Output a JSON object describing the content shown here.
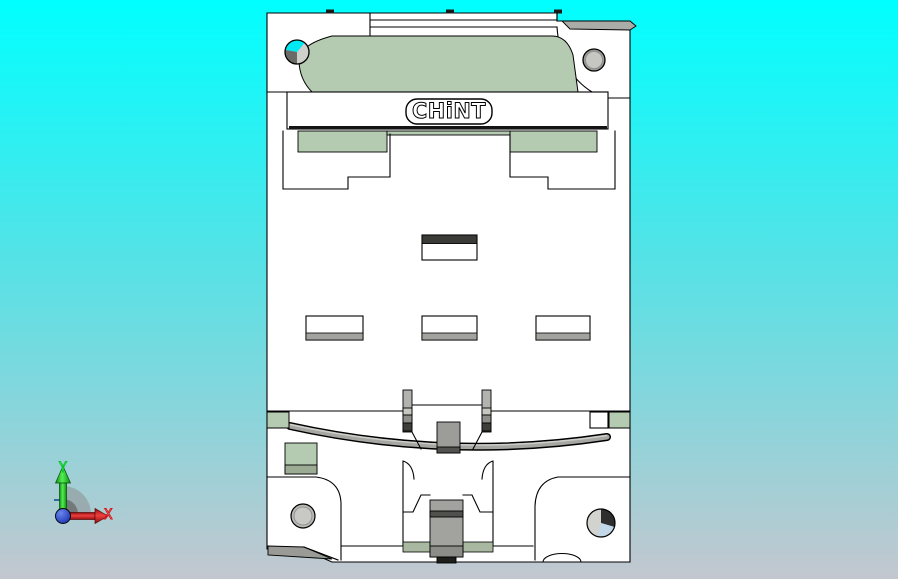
{
  "viewport": {
    "width": 898,
    "height": 579,
    "background_top": "#00ffff",
    "background_mid": "#55e2e6",
    "background_bottom": "#c3c7cf"
  },
  "model": {
    "brand_label": "CHiNT",
    "body_color": "#ffffff",
    "panel_green": "#b4cab1",
    "band_green": "#a9b9a1",
    "outline_color": "#000000",
    "metal_gray": "#a6a6a2",
    "dark_gray": "#3a3a36",
    "hole_gray": "#c2c2be",
    "hole_dark": "#2e2e2e",
    "hole_blue": "#c2d8e8"
  },
  "axes": {
    "x_label": "X",
    "y_label": "Y",
    "x_color": "#dd1111",
    "y_color": "#00cc22",
    "origin_color": "#1838cc",
    "fan_color": "#8a8a8a"
  }
}
